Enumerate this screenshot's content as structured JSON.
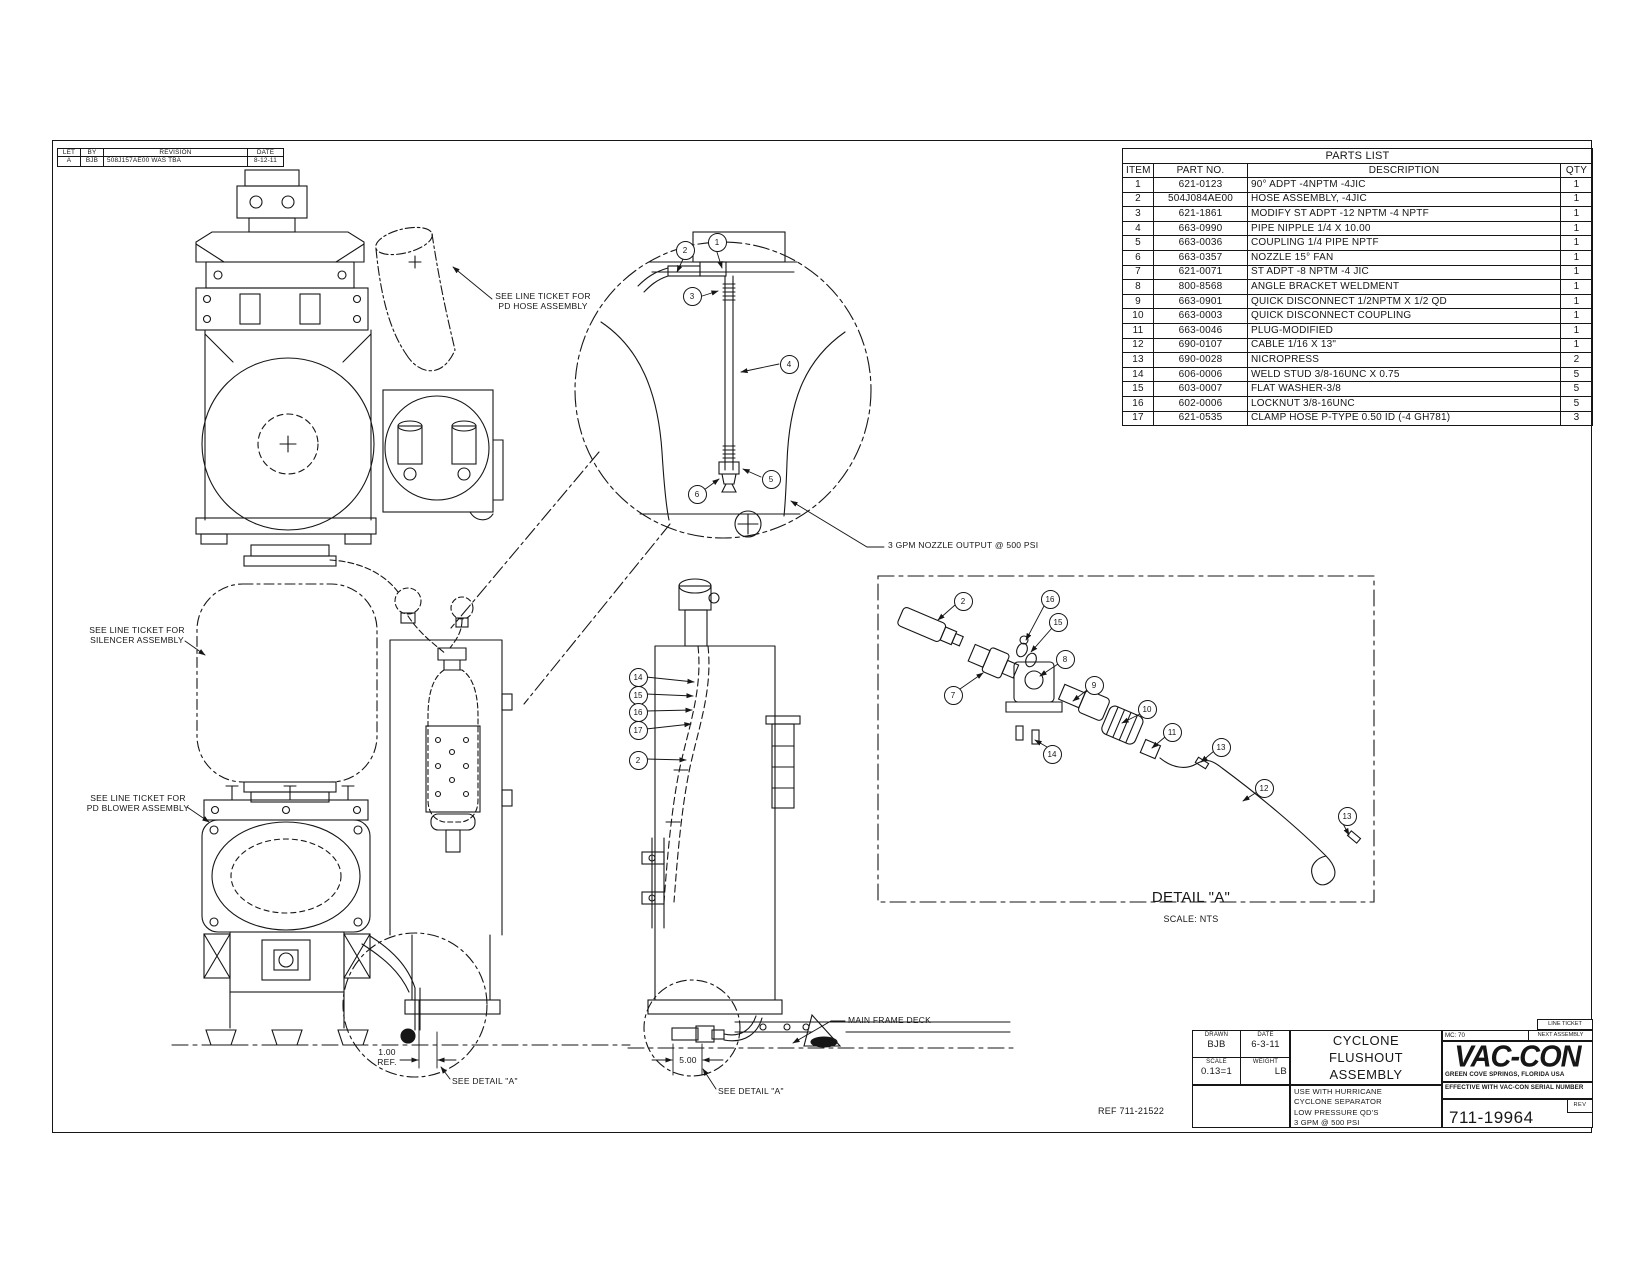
{
  "sheet": {
    "background": "#ffffff",
    "line_color": "#161616"
  },
  "revision_table": {
    "headers": [
      "LET",
      "BY",
      "REVISION",
      "DATE"
    ],
    "rows": [
      [
        "A",
        "BJB",
        "508J157AE00 WAS TBA",
        "8-12-11"
      ]
    ]
  },
  "parts_list": {
    "title": "PARTS LIST",
    "headers": [
      "ITEM",
      "PART NO.",
      "DESCRIPTION",
      "QTY"
    ],
    "rows": [
      [
        "1",
        "621-0123",
        "90° ADPT -4NPTM -4JIC",
        "1"
      ],
      [
        "2",
        "504J084AE00",
        "HOSE ASSEMBLY, -4JIC",
        "1"
      ],
      [
        "3",
        "621-1861",
        "MODIFY ST ADPT -12 NPTM -4 NPTF",
        "1"
      ],
      [
        "4",
        "663-0990",
        "PIPE NIPPLE 1/4 X 10.00",
        "1"
      ],
      [
        "5",
        "663-0036",
        "COUPLING 1/4 PIPE NPTF",
        "1"
      ],
      [
        "6",
        "663-0357",
        "NOZZLE 15° FAN",
        "1"
      ],
      [
        "7",
        "621-0071",
        "ST ADPT -8 NPTM -4 JIC",
        "1"
      ],
      [
        "8",
        "800-8568",
        "ANGLE BRACKET WELDMENT",
        "1"
      ],
      [
        "9",
        "663-0901",
        "QUICK DISCONNECT 1/2NPTM X 1/2 QD",
        "1"
      ],
      [
        "10",
        "663-0003",
        "QUICK DISCONNECT COUPLING",
        "1"
      ],
      [
        "11",
        "663-0046",
        "PLUG-MODIFIED",
        "1"
      ],
      [
        "12",
        "690-0107",
        "CABLE 1/16 X 13\"",
        "1"
      ],
      [
        "13",
        "690-0028",
        "NICROPRESS",
        "2"
      ],
      [
        "14",
        "606-0006",
        "WELD STUD 3/8-16UNC X 0.75",
        "5"
      ],
      [
        "15",
        "603-0007",
        "FLAT WASHER-3/8",
        "5"
      ],
      [
        "16",
        "602-0006",
        "LOCKNUT 3/8-16UNC",
        "5"
      ],
      [
        "17",
        "621-0535",
        "CLAMP HOSE P-TYPE 0.50 ID (-4 GH781)",
        "3"
      ]
    ]
  },
  "title_block": {
    "drawn_label": "DRAWN",
    "drawn_value": "BJB",
    "date_label": "DATE",
    "date_value": "6-3-11",
    "scale_label": "SCALE",
    "scale_value": "0.13=1",
    "weight_label": "WEIGHT",
    "weight_value": "LB",
    "title": "CYCLONE\nFLUSHOUT\nASSEMBLY",
    "notes": "USE WITH HURRICANE\nCYCLONE SEPARATOR\nLOW PRESSURE QD'S\n3 GPM @ 500 PSI",
    "line_ticket_label": "LINE TICKET",
    "mc_label": "MC: 70",
    "next_assembly_label": "NEXT ASSEMBLY",
    "logo_text": "VAC-CON",
    "logo_address": "GREEN COVE SPRINGS, FLORIDA USA",
    "effective_note": "EFFECTIVE WITH VAC-CON SERIAL NUMBER",
    "drawing_number": "711-19964",
    "rev_label": "REV"
  },
  "annotations": [
    {
      "id": "pd-hose-note",
      "text": "SEE LINE TICKET FOR\nPD HOSE ASSEMBLY",
      "x": 543,
      "y": 291,
      "align": "center",
      "size": 8.5
    },
    {
      "id": "nozzle-output-note",
      "text": "3 GPM NOZZLE OUTPUT @ 500 PSI",
      "x": 888,
      "y": 540,
      "align": "left",
      "size": 8.5
    },
    {
      "id": "silencer-note",
      "text": "SEE LINE TICKET FOR\nSILENCER ASSEMBLY",
      "x": 137,
      "y": 625,
      "align": "center",
      "size": 8.5
    },
    {
      "id": "pd-blower-note",
      "text": "SEE LINE TICKET FOR\nPD BLOWER ASSEMBLY",
      "x": 138,
      "y": 793,
      "align": "center",
      "size": 8.5
    },
    {
      "id": "detail-a-title",
      "text": "DETAIL \"A\"",
      "x": 1191,
      "y": 889,
      "align": "center",
      "size": 15
    },
    {
      "id": "detail-a-scale",
      "text": "SCALE: NTS",
      "x": 1191,
      "y": 914,
      "align": "center",
      "size": 9
    },
    {
      "id": "main-frame-deck-label",
      "text": "MAIN FRAME DECK",
      "x": 848,
      "y": 1015,
      "align": "left",
      "size": 8.5
    },
    {
      "id": "dim-1-00-ref",
      "text": "1.00\nREF.",
      "x": 387,
      "y": 1047,
      "align": "center",
      "size": 8.5
    },
    {
      "id": "dim-5-00",
      "text": "5.00",
      "x": 688,
      "y": 1055,
      "align": "center",
      "size": 8.5
    },
    {
      "id": "see-detail-a-note-1",
      "text": "SEE DETAIL \"A\"",
      "x": 452,
      "y": 1076,
      "align": "left",
      "size": 8.5
    },
    {
      "id": "see-detail-a-note-2",
      "text": "SEE DETAIL \"A\"",
      "x": 718,
      "y": 1086,
      "align": "left",
      "size": 8.5
    },
    {
      "id": "ref-number-note",
      "text": "REF 711-21522",
      "x": 1098,
      "y": 1106,
      "align": "left",
      "size": 9
    }
  ],
  "balloons": [
    {
      "n": "1",
      "x": 716,
      "y": 241
    },
    {
      "n": "2",
      "x": 684,
      "y": 249
    },
    {
      "n": "3",
      "x": 691,
      "y": 295
    },
    {
      "n": "4",
      "x": 788,
      "y": 363
    },
    {
      "n": "5",
      "x": 770,
      "y": 478
    },
    {
      "n": "6",
      "x": 696,
      "y": 493
    },
    {
      "n": "14",
      "x": 637,
      "y": 676
    },
    {
      "n": "15",
      "x": 637,
      "y": 694
    },
    {
      "n": "16",
      "x": 637,
      "y": 711
    },
    {
      "n": "17",
      "x": 637,
      "y": 729
    },
    {
      "n": "2",
      "x": 637,
      "y": 759
    },
    {
      "n": "2",
      "x": 962,
      "y": 600
    },
    {
      "n": "16",
      "x": 1049,
      "y": 598
    },
    {
      "n": "15",
      "x": 1057,
      "y": 621
    },
    {
      "n": "8",
      "x": 1064,
      "y": 658
    },
    {
      "n": "7",
      "x": 952,
      "y": 694
    },
    {
      "n": "9",
      "x": 1093,
      "y": 684
    },
    {
      "n": "10",
      "x": 1146,
      "y": 708
    },
    {
      "n": "11",
      "x": 1171,
      "y": 731
    },
    {
      "n": "14",
      "x": 1051,
      "y": 753
    },
    {
      "n": "13",
      "x": 1220,
      "y": 746
    },
    {
      "n": "12",
      "x": 1263,
      "y": 787
    },
    {
      "n": "13",
      "x": 1346,
      "y": 815
    }
  ]
}
